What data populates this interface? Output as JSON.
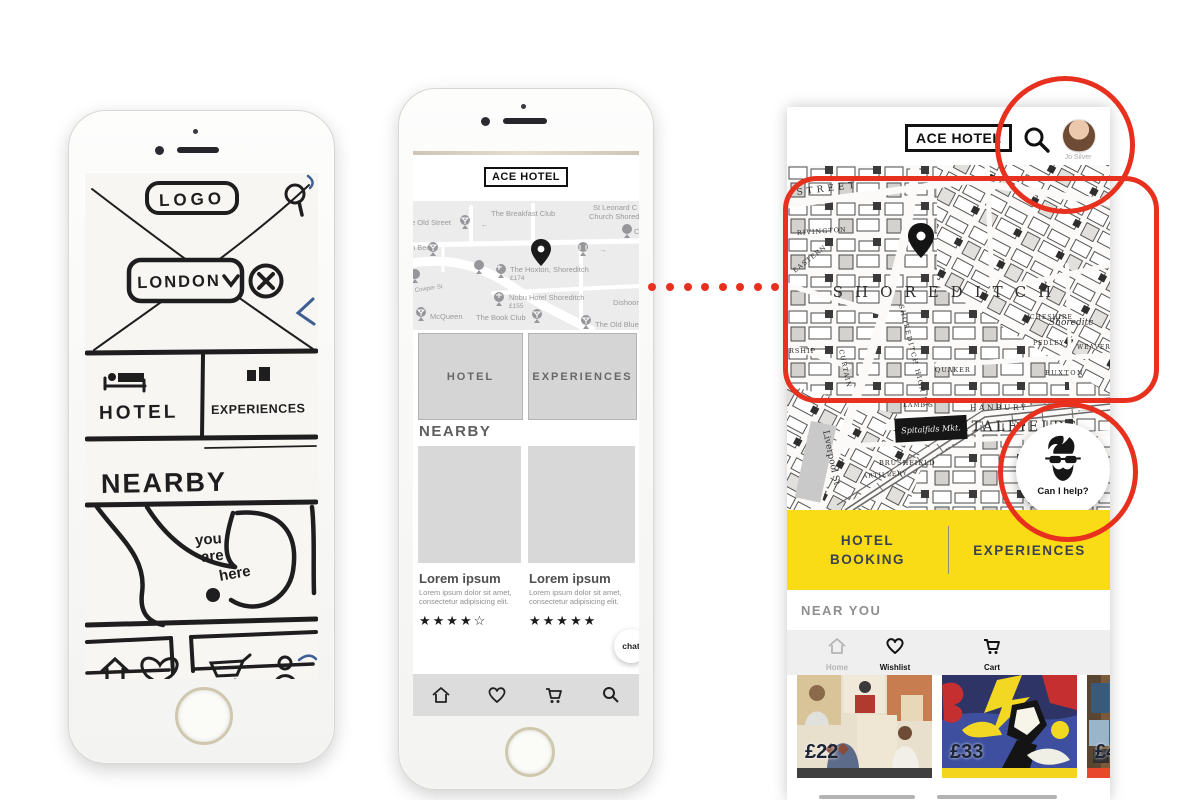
{
  "colors": {
    "annotation_red": "#e8301f",
    "tab_yellow": "#f9dc15",
    "bar_dark": "#3f3f3f",
    "bar_yellow": "#f4d51e",
    "bar_red": "#e8472b"
  },
  "sketch": {
    "logo": "LOGO",
    "city": "LONDON",
    "tab_hotel": "HOTEL",
    "tab_experiences": "EXPERIENCES",
    "section_nearby": "NEARBY",
    "note_lines": [
      "you",
      "are",
      "here"
    ]
  },
  "wireframe": {
    "logo": "ACE HOTEL",
    "map": {
      "old_street": "e Old Street",
      "breakfast_club": "The Breakfast Club",
      "st_leonard1": "St Leonard C o",
      "st_leonard2": "Church Shoredit",
      "cargo": "Carg",
      "n_bee": "n Bee",
      "hoxton": "The Hoxton, Shoreditch",
      "hoxton_price": "£174",
      "cowper": "Cowper St",
      "nobu": "Nobu Hotel Shoreditch",
      "nobu_price": "£155",
      "dishoom": "Dishoom S",
      "mcqueen": "McQueen",
      "book_club": "The Book Club",
      "old_blue": "The Old Blue L"
    },
    "btn_hotel": "HOTEL",
    "btn_experiences": "EXPERIENCES",
    "section_nearby": "NEARBY",
    "cards": [
      {
        "title": "Lorem ipsum",
        "body": "Lorem ipsum dolor sit amet, consectetur adipisicing elit.",
        "stars": "★★★★☆"
      },
      {
        "title": "Lorem ipsum",
        "body": "Lorem ipsum dolor sit amet, consectetur adipisicing elit.",
        "stars": "★★★★★"
      }
    ],
    "chat_label": "chat"
  },
  "hifi": {
    "logo": "ACE HOTEL",
    "user_name": "Jo Silver",
    "map": {
      "street": "STREET",
      "rivington": "RIVINGTON",
      "eastern": "EASTERN",
      "curtain": "CURTAIN",
      "high_st": "SHOREDITCH HIGH ST",
      "district": "SHOREDITCH",
      "station": "Shoreditc",
      "cheshire": "CHESHIRE",
      "pedley": "PEDLEY",
      "weaver": "WEAVER",
      "buxton": "BUXTON",
      "quaker": "QUAKER",
      "rship": "RSHIP",
      "hanbury": "HANBURY",
      "lamb": "LAMB S",
      "district2": "SPITALFIELDS",
      "market": "Spitalfids Mkt.",
      "brushfield": "BRUSHFIELD",
      "artillery": "ARTILLERY",
      "liverpool": "Liverpool St."
    },
    "assistant_label": "Can I help?",
    "tabs": {
      "hotel1": "HOTEL",
      "hotel2": "BOOKING",
      "experiences": "EXPERIENCES"
    },
    "section_near_you": "NEAR YOU",
    "nav": [
      {
        "label": "Home",
        "active": false
      },
      {
        "label": "Wishlist",
        "active": true
      },
      {
        "label": "Cart",
        "active": true
      }
    ],
    "products": [
      {
        "price": "£22"
      },
      {
        "price": "£33"
      },
      {
        "price": "£4"
      }
    ]
  }
}
